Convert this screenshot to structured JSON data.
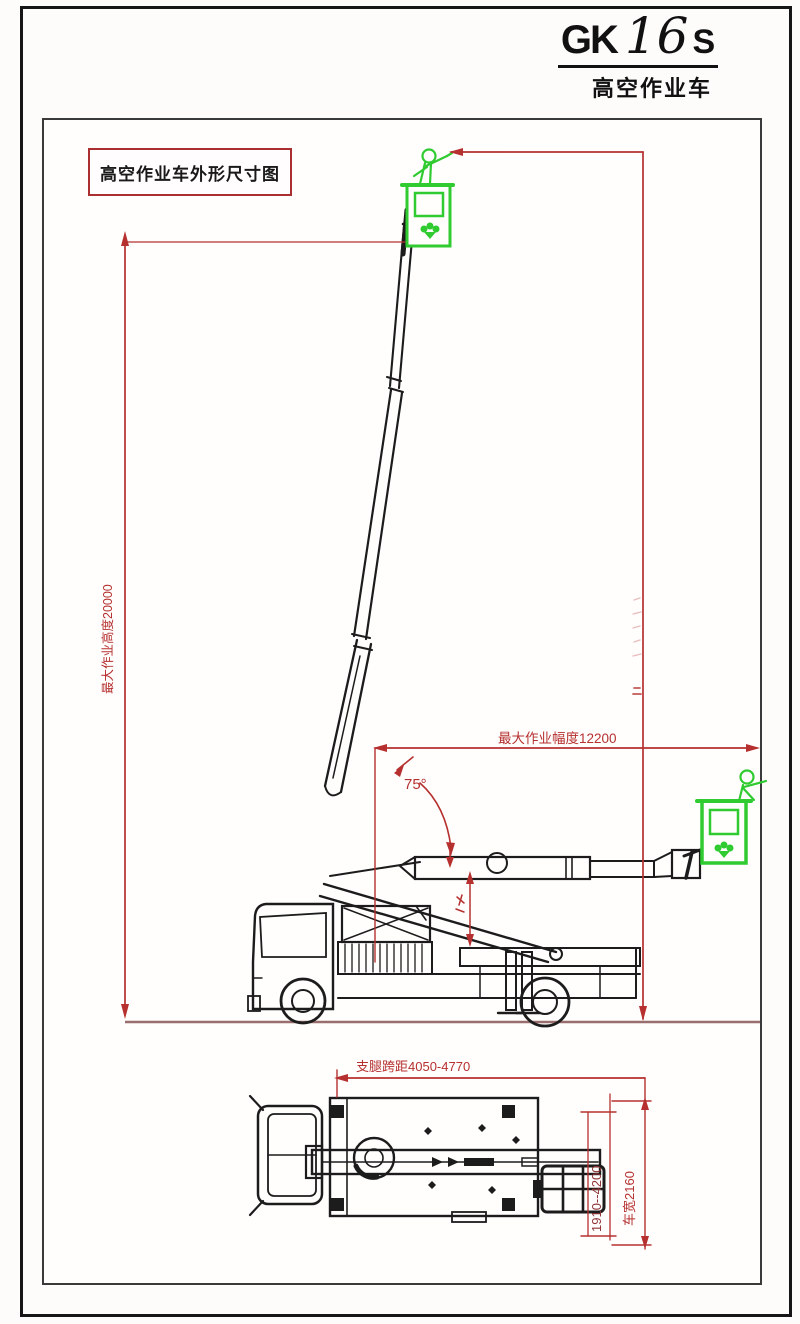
{
  "header": {
    "model_prefix": "GK",
    "model_digits": "16",
    "model_suffix": "S",
    "subtitle": "高空作业车"
  },
  "drawing": {
    "label_box_text": "高空作业车外形尺寸图",
    "angle_label": "75°",
    "dim_height_label": "最大作业高度20000",
    "dim_radius_label": "最大作业幅度12200",
    "dim_outrigger_span_label": "支腿跨距4050-4770",
    "dim_lateral_span_label": "1910--4200",
    "dim_width_label": "车宽2160"
  },
  "colors": {
    "dimension_red": "#b5302f",
    "drawing_black": "#1c1c1c",
    "basket_green": "#2fcb30",
    "ground_line": "#9a6e6e"
  }
}
